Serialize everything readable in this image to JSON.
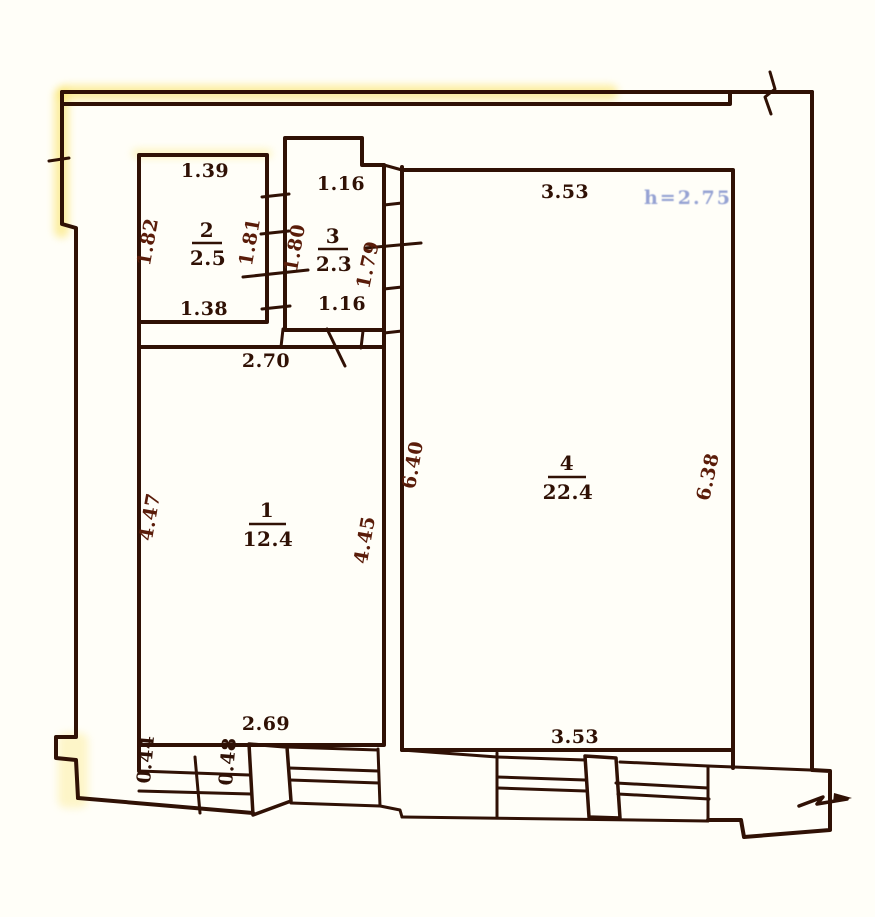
{
  "drawing": {
    "title": "apartment-floor-plan-scan",
    "height_note": "h=2.75",
    "rooms": {
      "r1": {
        "number": "1",
        "area": "12.4",
        "top": "2.70",
        "left": "4.47",
        "right": "4.45",
        "bottom": "2.69"
      },
      "r2": {
        "number": "2",
        "area": "2.5",
        "top": "1.39",
        "left": "1.82",
        "right": "1.81",
        "bottom": "1.38"
      },
      "r3": {
        "number": "3",
        "area": "2.3",
        "top": "1.16",
        "left": "1.80",
        "right": "1.79",
        "bottom": "1.16"
      },
      "r4": {
        "number": "4",
        "area": "22.4",
        "top": "3.53",
        "left": "6.40",
        "right": "6.38",
        "bottom": "3.53"
      }
    },
    "opening_dims": {
      "w044": "0.44",
      "w048": "0.48"
    },
    "colors": {
      "ink": "#301105",
      "side_ink": "#5a1c09",
      "note_blue": "#3f57b5",
      "paper": "#fffef8",
      "highlight": "#f8e06a"
    }
  }
}
